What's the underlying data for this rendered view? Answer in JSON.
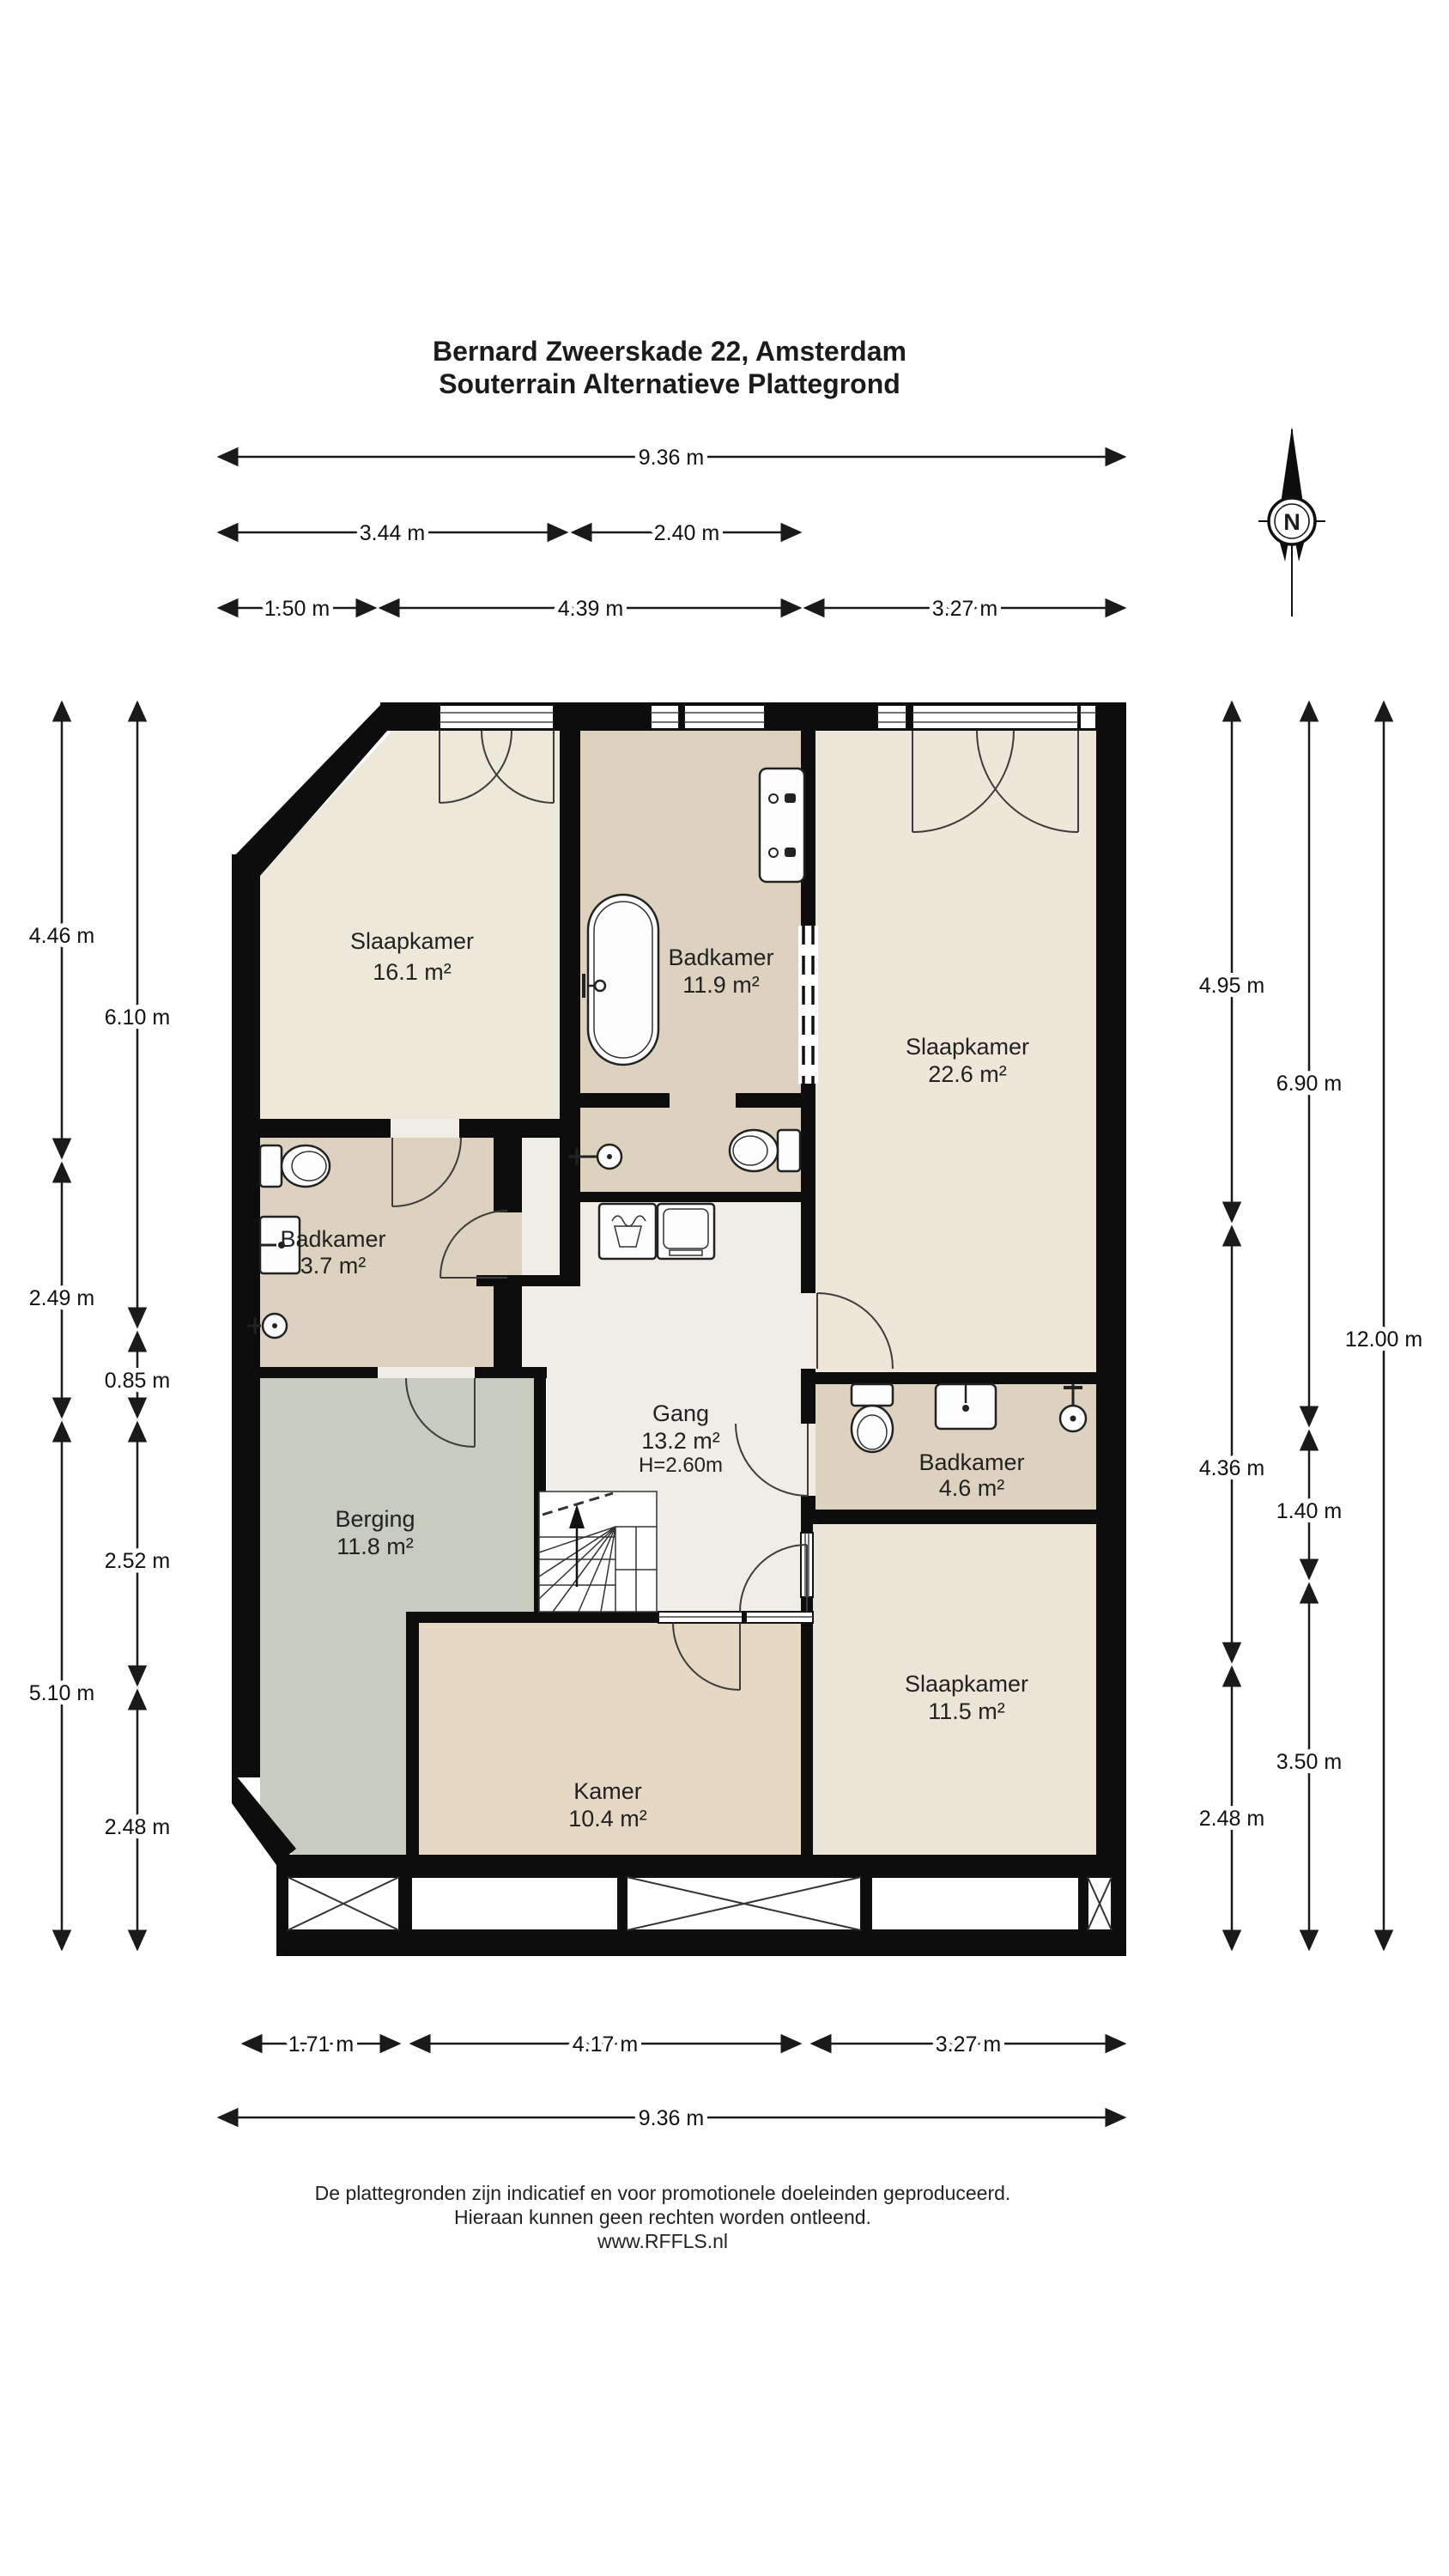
{
  "title": {
    "line1": "Bernard Zweerskade 22, Amsterdam",
    "line2": "Souterrain Alternatieve Plattegrond"
  },
  "compass": {
    "label": "N"
  },
  "rooms": {
    "slaapkamer_1": {
      "name": "Slaapkamer",
      "area": "16.1 m²"
    },
    "badkamer_1": {
      "name": "Badkamer",
      "area": "11.9 m²"
    },
    "slaapkamer_2": {
      "name": "Slaapkamer",
      "area": "22.6 m²"
    },
    "badkamer_2": {
      "name": "Badkamer",
      "area": "3.7 m²"
    },
    "gang": {
      "name": "Gang",
      "area": "13.2 m²",
      "height": "H=2.60m"
    },
    "badkamer_3": {
      "name": "Badkamer",
      "area": "4.6 m²"
    },
    "berging": {
      "name": "Berging",
      "area": "11.8 m²"
    },
    "kamer": {
      "name": "Kamer",
      "area": "10.4 m²"
    },
    "slaapkamer_3": {
      "name": "Slaapkamer",
      "area": "11.5 m²"
    }
  },
  "dimensions": {
    "top": [
      {
        "label": "9.36 m",
        "meters": 9.36
      },
      {
        "label": "3.44 m",
        "meters": 3.44
      },
      {
        "label": "2.40 m",
        "meters": 2.4
      },
      {
        "label": "1.50 m",
        "meters": 1.5
      },
      {
        "label": "4.39 m",
        "meters": 4.39
      },
      {
        "label": "3.27 m",
        "meters": 3.27
      }
    ],
    "left": [
      {
        "label": "4.46 m",
        "meters": 4.46
      },
      {
        "label": "2.49 m",
        "meters": 2.49
      },
      {
        "label": "5.10 m",
        "meters": 5.1
      },
      {
        "label": "6.10 m",
        "meters": 6.1
      },
      {
        "label": "0.85 m",
        "meters": 0.85
      },
      {
        "label": "2.52 m",
        "meters": 2.52
      },
      {
        "label": "2.48 m",
        "meters": 2.48
      }
    ],
    "right": [
      {
        "label": "4.95 m",
        "meters": 4.95
      },
      {
        "label": "4.36 m",
        "meters": 4.36
      },
      {
        "label": "2.48 m",
        "meters": 2.48
      },
      {
        "label": "6.90 m",
        "meters": 6.9
      },
      {
        "label": "1.40 m",
        "meters": 1.4
      },
      {
        "label": "3.50 m",
        "meters": 3.5
      },
      {
        "label": "12.00 m",
        "meters": 12.0
      }
    ],
    "bottom": [
      {
        "label": "1.71 m",
        "meters": 1.71
      },
      {
        "label": "4.17 m",
        "meters": 4.17
      },
      {
        "label": "3.27 m",
        "meters": 3.27
      },
      {
        "label": "9.36 m",
        "meters": 9.36
      }
    ]
  },
  "footer": {
    "line1": "De plattegronden zijn indicatief en voor promotionele doeleinden geproduceerd.",
    "line2": "Hieraan kunnen geen rechten worden ontleend.",
    "line3": "www.RFFLS.nl"
  },
  "colors": {
    "wall": "#0d0d0d",
    "bedroom1_floor": "#ede9da",
    "bathroom_floor": "#dcd2bf",
    "bedroom2_floor": "#ece7d8",
    "bedroom3_floor": "#eae5d6",
    "gang_floor": "#efede5",
    "berging_floor": "#c7cbc0",
    "kamer_floor": "#e5d9c5"
  }
}
